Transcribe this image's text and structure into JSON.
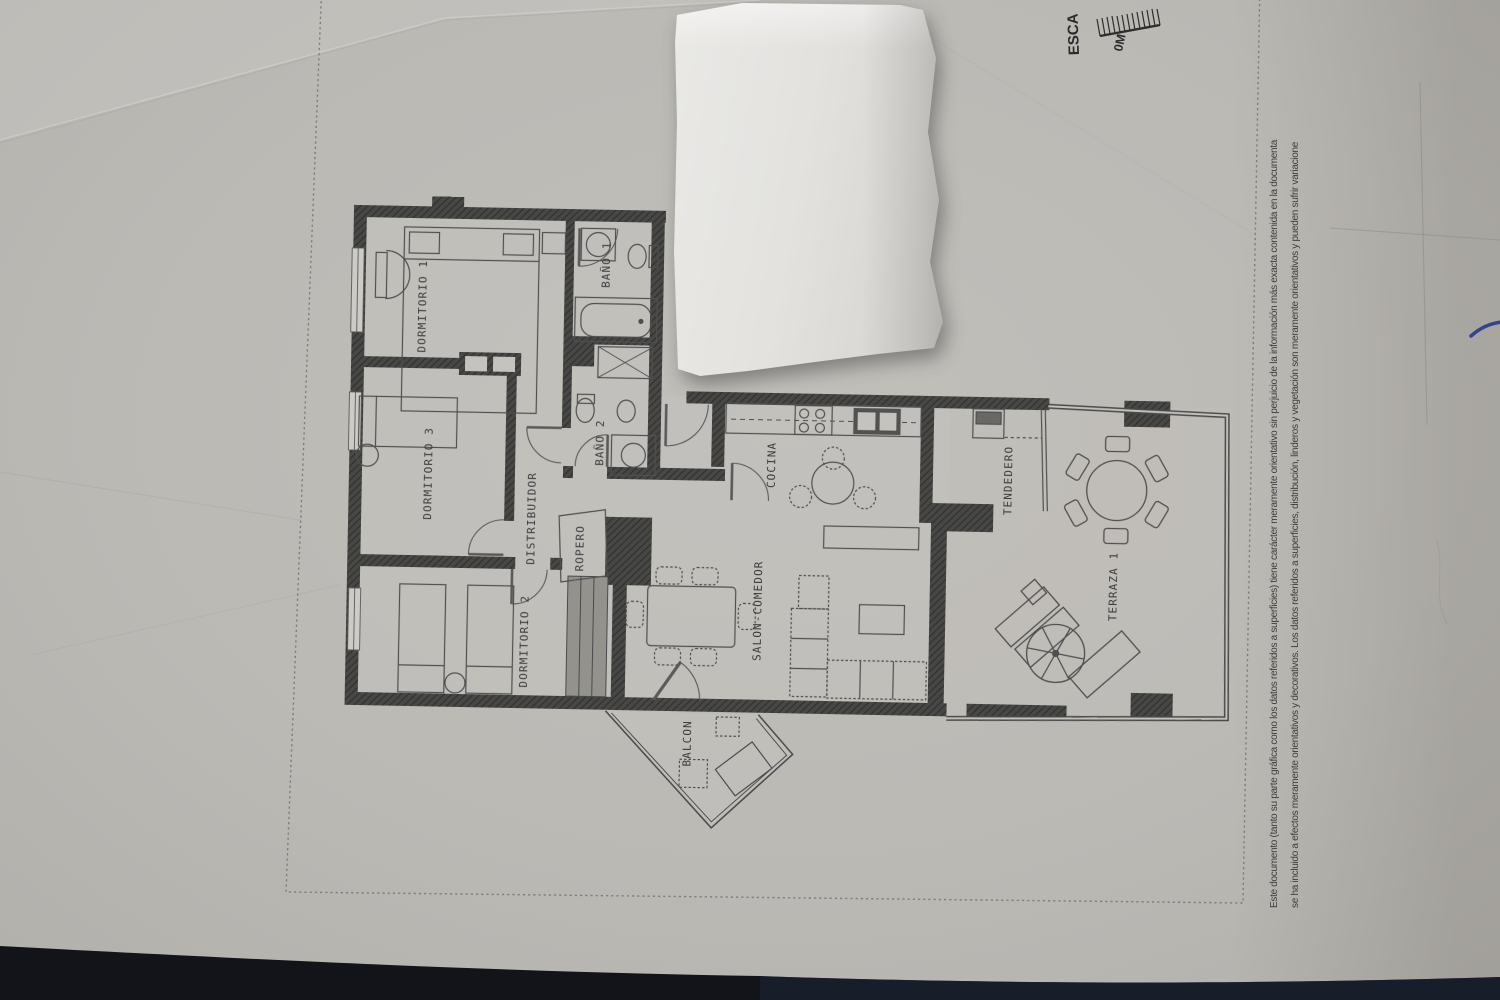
{
  "floor_plan": {
    "rooms": [
      {
        "label": "DORMITORIO 1"
      },
      {
        "label": "BAÑO 1"
      },
      {
        "label": "BAÑO 2"
      },
      {
        "label": "DORMITORIO 3"
      },
      {
        "label": "DISTRIBUIDOR"
      },
      {
        "label": "ROPERO"
      },
      {
        "label": "DORMITORIO 2"
      },
      {
        "label": "SALON-COMEDOR"
      },
      {
        "label": "COCINA"
      },
      {
        "label": "TENDEDERO"
      },
      {
        "label": "TERRAZA 1"
      },
      {
        "label": "BALCON"
      }
    ],
    "scale": {
      "label": "ESCA",
      "zero_mark": "0M"
    },
    "disclaimer": {
      "line1": "Este documento (tanto su parte gráfica como los datos referidos a superficies) tiene carácter meramente orientativo sin perjuicio de la información más exacta contenida en la documenta",
      "line2": "se ha incluido a efectos meramente orientativos y decorativos. Los datos referidos a superficies, distribución, linderos y vegetación son meramente orientativos y pueden sufrir variacione"
    }
  },
  "colors": {
    "paper": "#bcbab5",
    "plan_ink": "#3e3e3e",
    "torn_paper": "#e6e5e2",
    "dark_surface": "#13161d",
    "pen_mark": "#36428c"
  }
}
